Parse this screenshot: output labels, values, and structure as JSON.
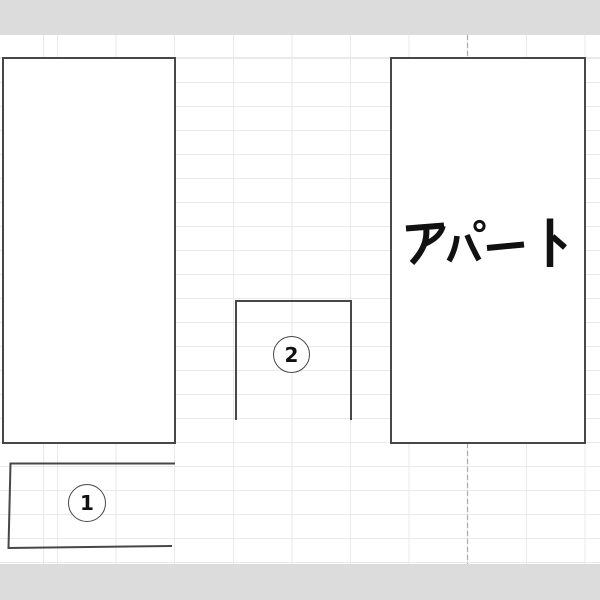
{
  "diagram": {
    "kind": "site-plan drawn on spreadsheet grid",
    "labels": {
      "apartment": "アパート",
      "marker_1": "1",
      "marker_2": "2"
    },
    "shapes": [
      {
        "name": "building-left",
        "type": "rectangle",
        "filled": true,
        "label": ""
      },
      {
        "name": "building-apartment",
        "type": "rectangle",
        "filled": true,
        "label": "アパート"
      },
      {
        "name": "lot-2",
        "type": "open-rectangle",
        "filled": false,
        "label": "2"
      },
      {
        "name": "lot-1",
        "type": "open-quad",
        "filled": false,
        "label": "1"
      }
    ],
    "page_break": {
      "orientation": "vertical",
      "style": "dashed"
    },
    "colors": {
      "background": "#ffffff",
      "band": "#dcdcdc",
      "gridline": "#e9e9e9",
      "shape_stroke": "#474747",
      "dashed_line": "#ababab",
      "text": "#111111"
    }
  }
}
